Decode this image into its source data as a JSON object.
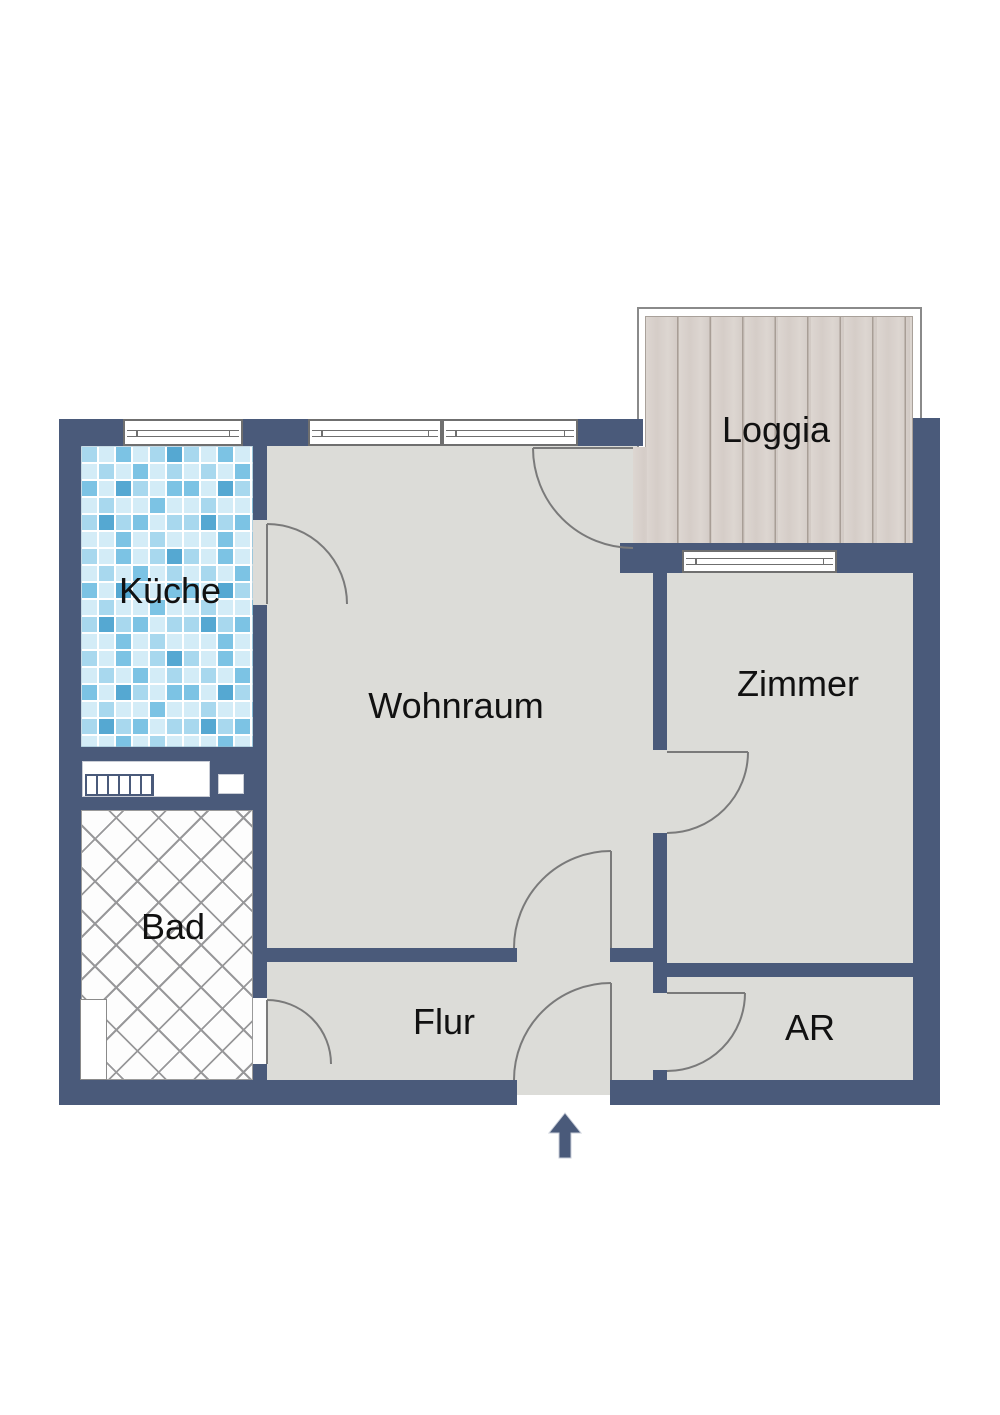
{
  "rooms": {
    "kueche": {
      "label": "Küche"
    },
    "wohnraum": {
      "label": "Wohnraum"
    },
    "loggia": {
      "label": "Loggia"
    },
    "zimmer": {
      "label": "Zimmer"
    },
    "bad": {
      "label": "Bad"
    },
    "flur": {
      "label": "Flur"
    },
    "ar": {
      "label": "AR"
    }
  },
  "colors": {
    "wall": "#4a5a7a",
    "floor": "#dcdcd8",
    "outline": "#7a7a7a",
    "window_frame": "#6f6f6f",
    "text": "#111111",
    "bad_hatch": "#98989a",
    "wood_base": "#d8d1cc",
    "wood_line": "#a89e96",
    "tile_grout": "#ffffff",
    "tile_light": "#d3ecf7",
    "tile_mid": "#a8d8ee",
    "tile_deep": "#7cc3e4",
    "tile_dark": "#55a8d2"
  }
}
